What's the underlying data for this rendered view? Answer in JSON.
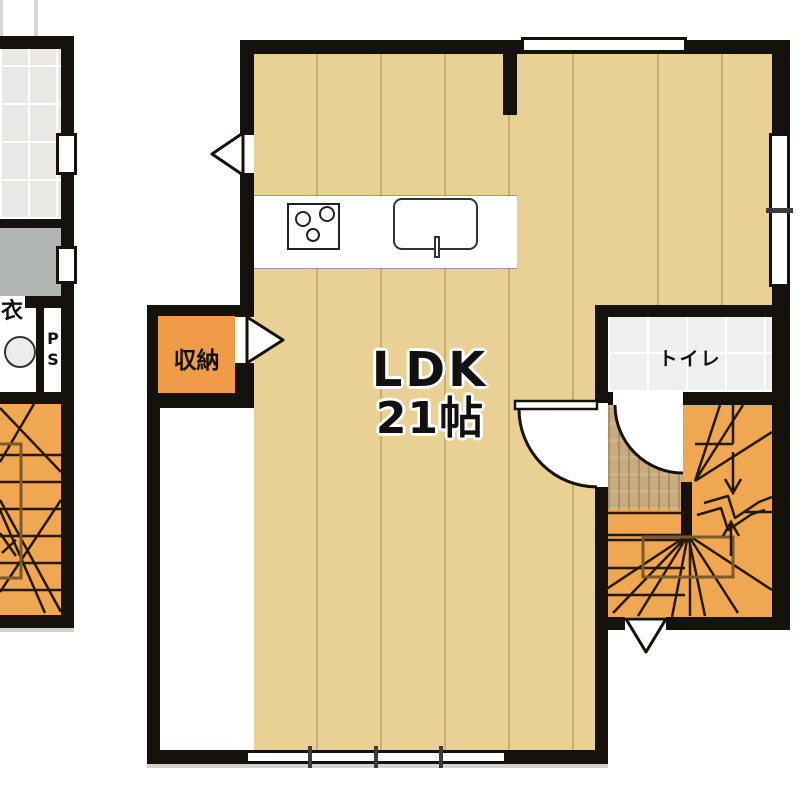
{
  "plan": {
    "main_room": {
      "name": "LDK",
      "size": "21帖"
    },
    "closet": {
      "label": "収納"
    },
    "toilet": {
      "label": "トイレ"
    },
    "left_wing": {
      "partial_room_label": "衣",
      "pipe_space": {
        "line1": "P",
        "line2": "S"
      }
    },
    "colors": {
      "wall": "#15120d",
      "wood_floor": "#e9d196",
      "stairs": "#f0a751",
      "closet": "#ef9b47",
      "hall_floor": "#c7ab7e",
      "bath_tile": "#e9e8e4",
      "toilet_tile": "#edf0ef",
      "utility_gray": "#b2b6b3",
      "rail_brown": "#7a5a2b"
    }
  }
}
